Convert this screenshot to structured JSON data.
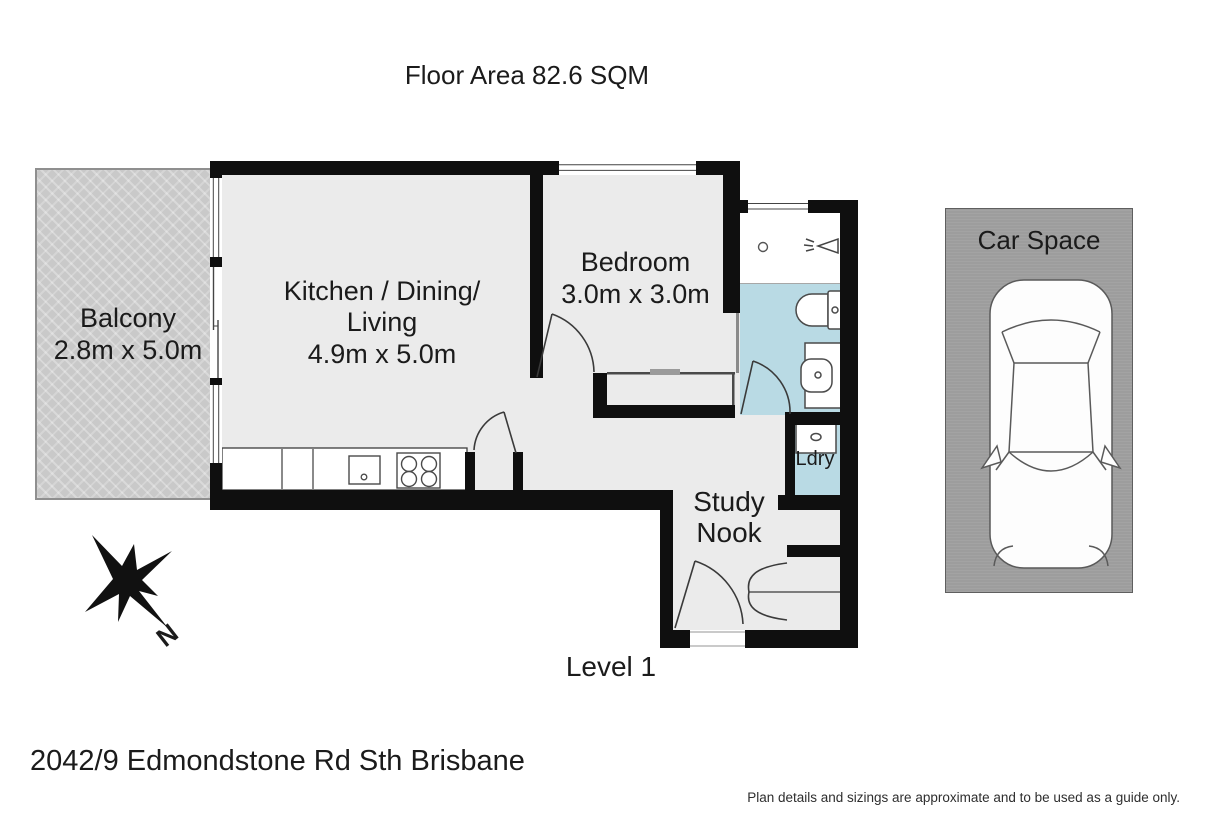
{
  "page": {
    "title": "Floor Area 82.6 SQM",
    "level_label": "Level 1",
    "address": "2042/9 Edmondstone Rd Sth Brisbane",
    "disclaimer": "Plan details and sizings are approximate and to be used as a guide only."
  },
  "rooms": {
    "balcony": {
      "name": "Balcony",
      "dims": "2.8m x 5.0m"
    },
    "living": {
      "line1": "Kitchen / Dining/",
      "line2": "Living",
      "dims": "4.9m x 5.0m"
    },
    "bedroom": {
      "name": "Bedroom",
      "dims": "3.0m x 3.0m"
    },
    "laundry": {
      "name": "Ldry"
    },
    "study": {
      "line1": "Study",
      "line2": "Nook"
    },
    "car_space": {
      "name": "Car Space"
    }
  },
  "compass": {
    "north_label": "N"
  },
  "colors": {
    "wall": "#0f0f0f",
    "floor": "#ebebeb",
    "wet_area": "#b9dae4",
    "balcony": "#c9c9c9",
    "car_space": "#9d9d9d",
    "text": "#1b1b1b"
  }
}
